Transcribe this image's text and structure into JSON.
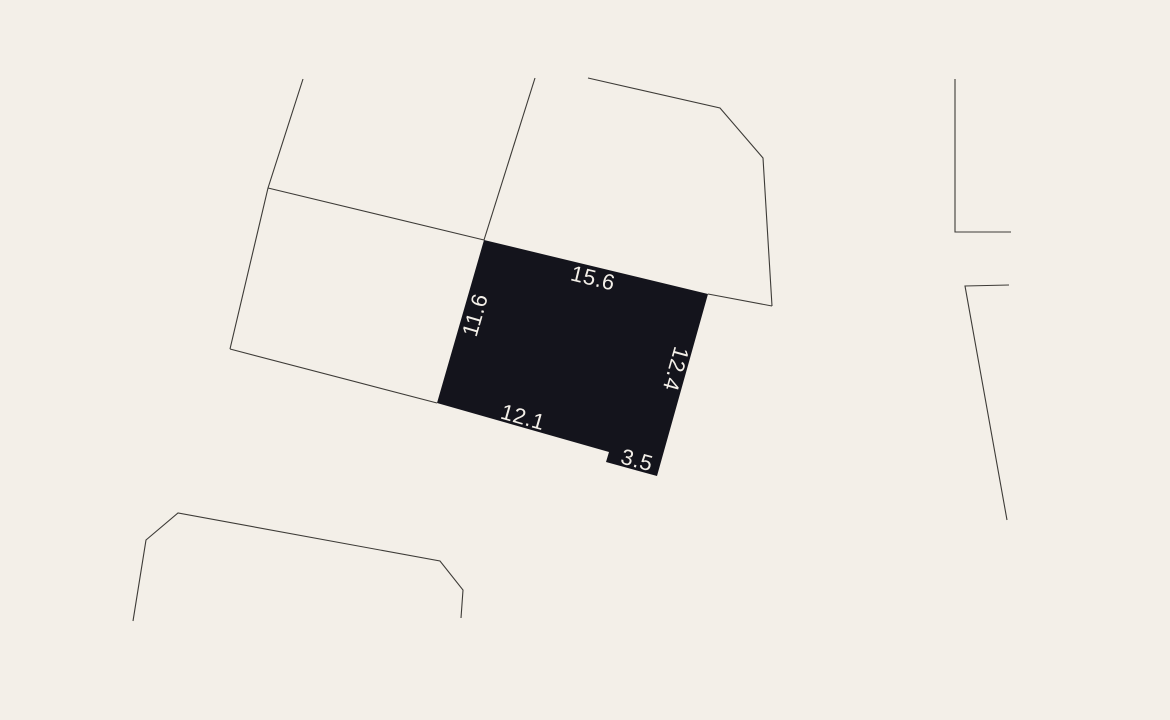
{
  "map": {
    "background_color": "#f3efe8",
    "boundary_line_color": "#3d3b37",
    "label_color": "#f3efe8",
    "parcel": {
      "fill_color": "#14141c",
      "dimensions": {
        "top": "15.6",
        "left": "11.6",
        "right": "12.4",
        "bottom": "12.1",
        "notch": "3.5"
      }
    }
  }
}
